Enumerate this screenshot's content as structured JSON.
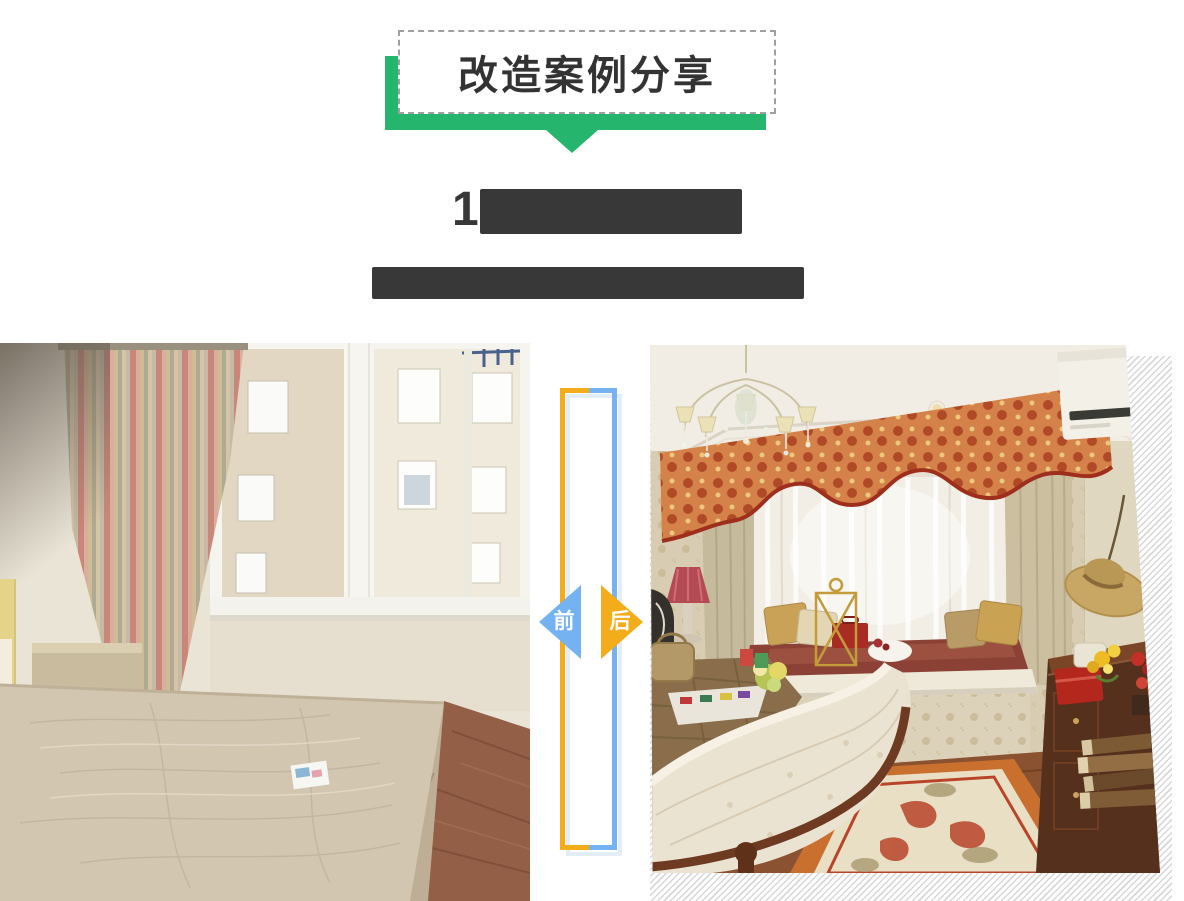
{
  "banner": {
    "title": "改造案例分享"
  },
  "heading": {
    "visible_text": "1",
    "redacted": true
  },
  "subheading": {
    "visible_text": "",
    "redacted": true
  },
  "comparison": {
    "before_label": "前",
    "after_label": "后",
    "before_photo_desc": "改造前的旧卧室：裸床垫、旧条纹窗帘、白框窗户、红砖地面",
    "after_photo_desc": "改造后的欧式卧室：水晶吊灯、花纹帷幔、飘窗纱帘、皮质床尾、木地板与花纹地毯"
  },
  "colors": {
    "green": "#25b56d",
    "blue": "#74b2f2",
    "orange": "#f3ad1b",
    "redact_bar": "#383838",
    "divider_shadow": "#e3edf5",
    "hatch_line": "#d7d7d7"
  }
}
